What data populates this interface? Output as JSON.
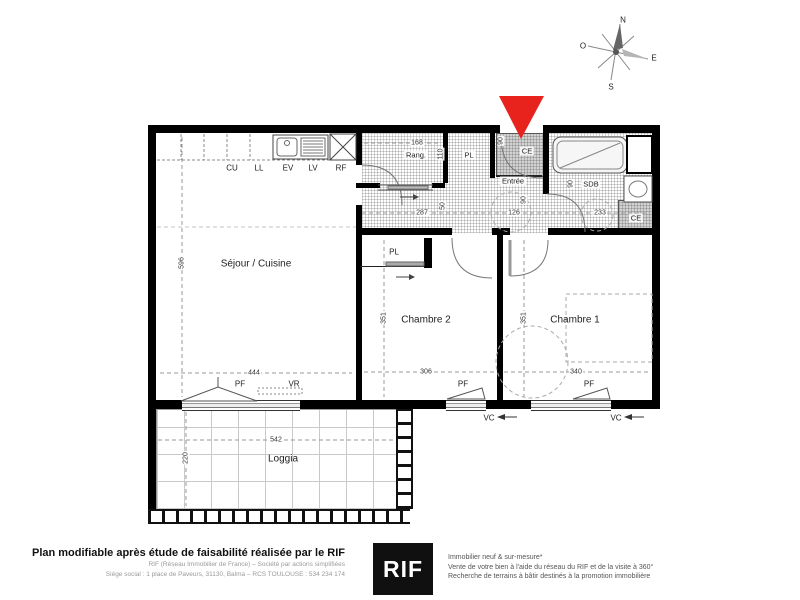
{
  "compass": {
    "north": "N",
    "south": "S",
    "west": "O",
    "east": "E"
  },
  "plan": {
    "rooms": {
      "sejour": "Séjour / Cuisine",
      "chambre2": "Chambre 2",
      "chambre1": "Chambre 1",
      "loggia": "Loggia",
      "entree": "Entrée",
      "sdb": "SDB",
      "rang": "Rang.",
      "pl": "PL",
      "ce": "CE"
    },
    "kitchen": {
      "cu": "CU",
      "ll": "LL",
      "ev": "EV",
      "lv": "LV",
      "rf": "RF"
    },
    "openings": {
      "pf": "PF",
      "vr": "VR",
      "vc": "VC"
    },
    "dims": {
      "sejour_h": "596",
      "sejour_w": "444",
      "chambre2_h": "351",
      "chambre2_w": "306",
      "chambre1_h": "351",
      "chambre1_w": "340",
      "loggia_w": "542",
      "loggia_h": "220",
      "rang_w": "168",
      "rang_d": "110",
      "hall_a": "287",
      "hall_b": "126",
      "sdb_w": "233",
      "door_entree": "90",
      "door_a": "50",
      "door_b": "90",
      "door_sdb": "90"
    }
  },
  "footer": {
    "left_bold": "Plan modifiable après étude de faisabilité réalisée par le RIF",
    "left_line2": "RIF (Réseau Immobilier de France) – Société par actions simplifiées",
    "left_line3": "Siège social : 1 place de Paveurs, 31130, Balma – RCS TOULOUSE : 534 234 174",
    "logo": "RIF",
    "right_line1": "Immobilier neuf & sur-mesure*",
    "right_line2": "Vente de votre bien à l'aide du réseau du RIF et de la visite à 360°",
    "right_line3": "Recherche de terrains à bâtir destinés à la promotion immobilière"
  },
  "colors": {
    "arrow_red": "#e8221c",
    "wall": "#000000"
  }
}
